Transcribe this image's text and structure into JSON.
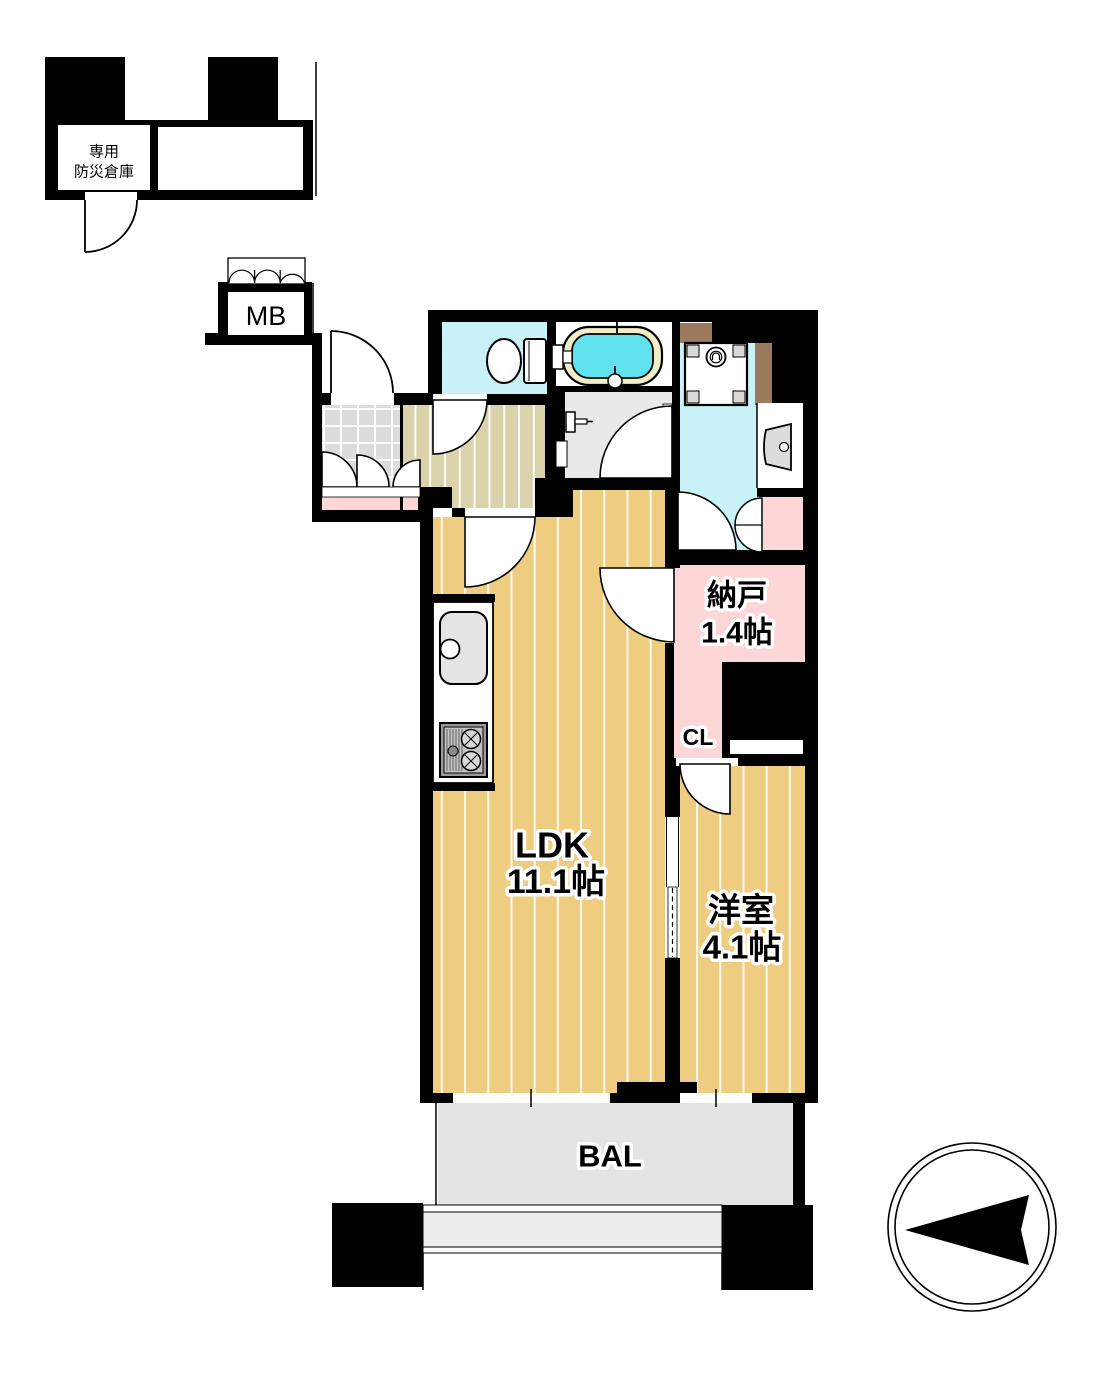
{
  "rooms": {
    "ldk": {
      "name": "LDK",
      "size": "11.1帖"
    },
    "western_room": {
      "name": "洋室",
      "size": "4.1帖"
    },
    "storage_room": {
      "name": "納戸",
      "size": "1.4帖"
    },
    "closet": {
      "label": "CL"
    },
    "balcony": {
      "label": "BAL"
    },
    "meter_box": {
      "label": "MB"
    },
    "disaster_storage": {
      "line1": "専用",
      "line2": "防災倉庫"
    }
  },
  "colors": {
    "wall": "#000000",
    "wood_floor": "#eecd80",
    "hall_floor": "#d9d2ab",
    "wet_floor": "#c9f2f8",
    "bath_water": "#5fe2ee",
    "tub_rim": "#f1edc8",
    "pink_room": "#fdd7d8",
    "balcony_floor": "#e4e4e4",
    "tile_floor": "#dcdcdc",
    "pipe_space": "#9b7a5d",
    "washroom_floor": "#e9e9e9"
  }
}
